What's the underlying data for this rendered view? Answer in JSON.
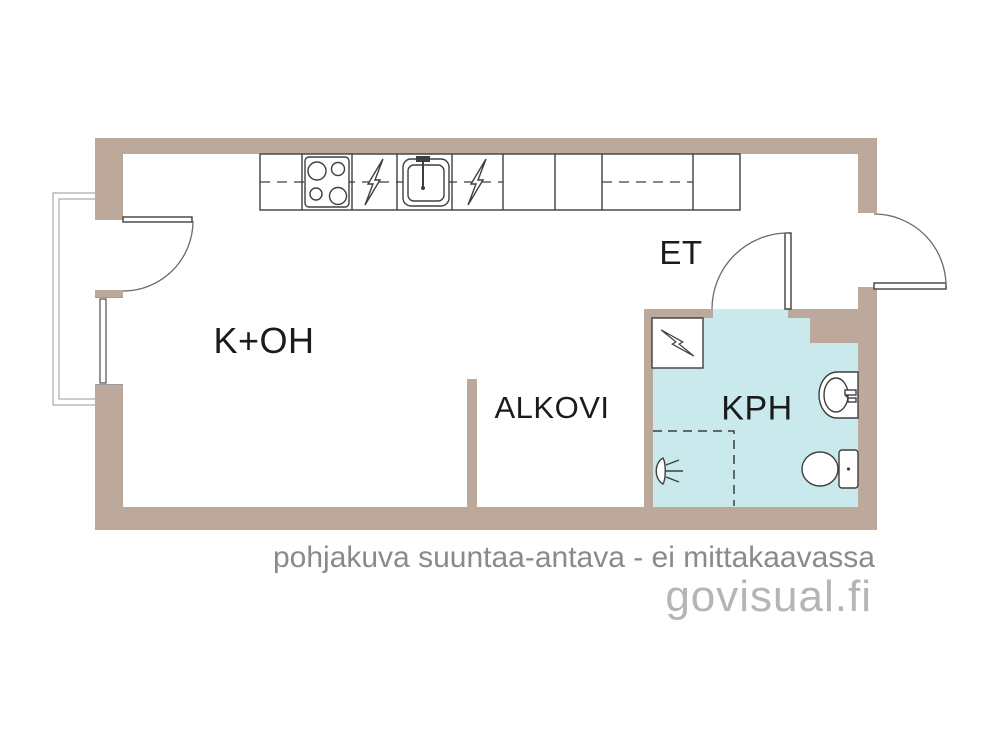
{
  "page": {
    "width": 1000,
    "height": 750,
    "background": "#ffffff"
  },
  "colors": {
    "wall": "#bca99c",
    "bathroom_floor": "#c9e9ed",
    "line_dark": "#3e3e3e",
    "line_mid": "#6b6b6b",
    "line_light": "#9a9a9a",
    "label_text": "#1b1b1b",
    "caption_text": "#8a8a8a",
    "logo_text": "#b5b5b7"
  },
  "rooms": {
    "kitchen_living": {
      "label": "K+OH"
    },
    "alcove": {
      "label": "ALKOVI"
    },
    "entry": {
      "label": "ET"
    },
    "bathroom": {
      "label": "KPH"
    }
  },
  "fixtures": {
    "stove": "stove-icon",
    "kitchen_sink": "sink-icon",
    "electric_appliance_1": "lightning-icon",
    "electric_appliance_2": "lightning-icon",
    "overhead_cabinet": "dashed-cabinet-icon",
    "electrical_cabinet": "lightning-icon",
    "washbasin": "washbasin-icon",
    "toilet": "toilet-icon",
    "shower": "shower-head-icon",
    "window": "window-icon",
    "balcony": "balcony-railing",
    "door_swing": "door-swing-arc"
  },
  "footer": {
    "caption": "pohjakuva suuntaa-antava - ei mittakaavassa",
    "brand": "govisual.fi"
  }
}
